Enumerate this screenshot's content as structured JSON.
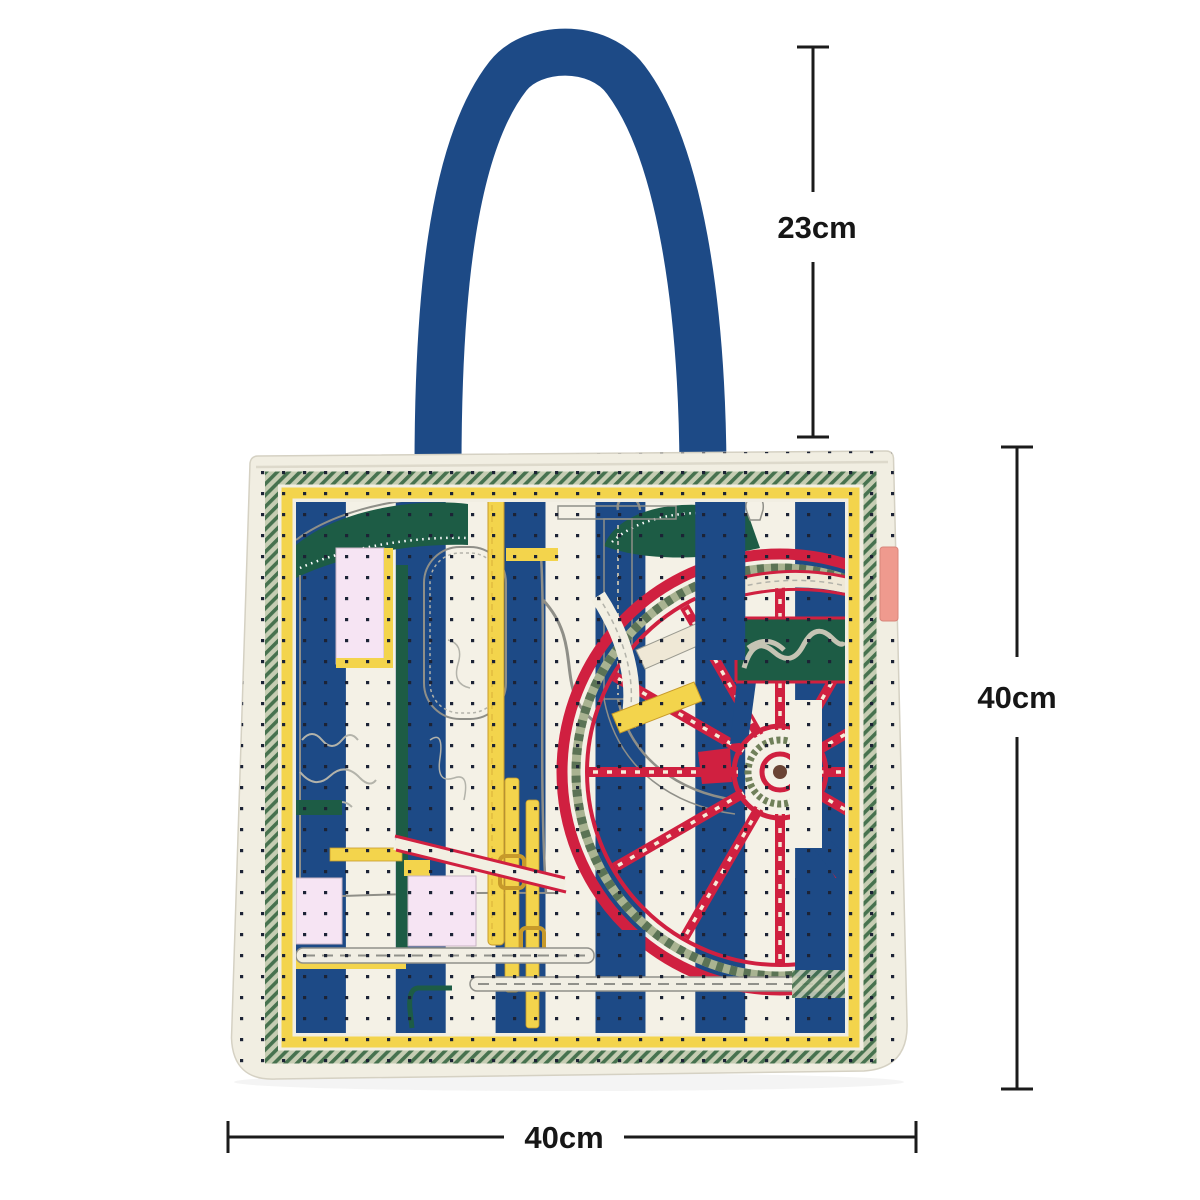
{
  "page": {
    "background": "#ffffff",
    "description": "Tote bag product dimension diagram"
  },
  "product": {
    "name": "striped carriage-print tote bag",
    "print_motifs": [
      "carriage line art",
      "phaeton wheel",
      "polka dots",
      "vertical stripes"
    ]
  },
  "colors": {
    "navy": "#1d4a86",
    "cream": "#f1eee2",
    "cream2": "#f4f1e6",
    "yellow": "#f3d44c",
    "red": "#d02040",
    "dgreen": "#1d5c45",
    "pink": "#f6e4f3",
    "tag": "#ef9a8e",
    "dot": "#1c2335",
    "rope_light": "#c6cdb3",
    "rope_dark": "#47724f",
    "gray": "#8f8f88",
    "dim": "#1b1b1b"
  },
  "dimensions": {
    "handle_drop": {
      "label": "23cm"
    },
    "bag_height": {
      "label": "40cm"
    },
    "bag_width": {
      "label": "40cm"
    }
  }
}
